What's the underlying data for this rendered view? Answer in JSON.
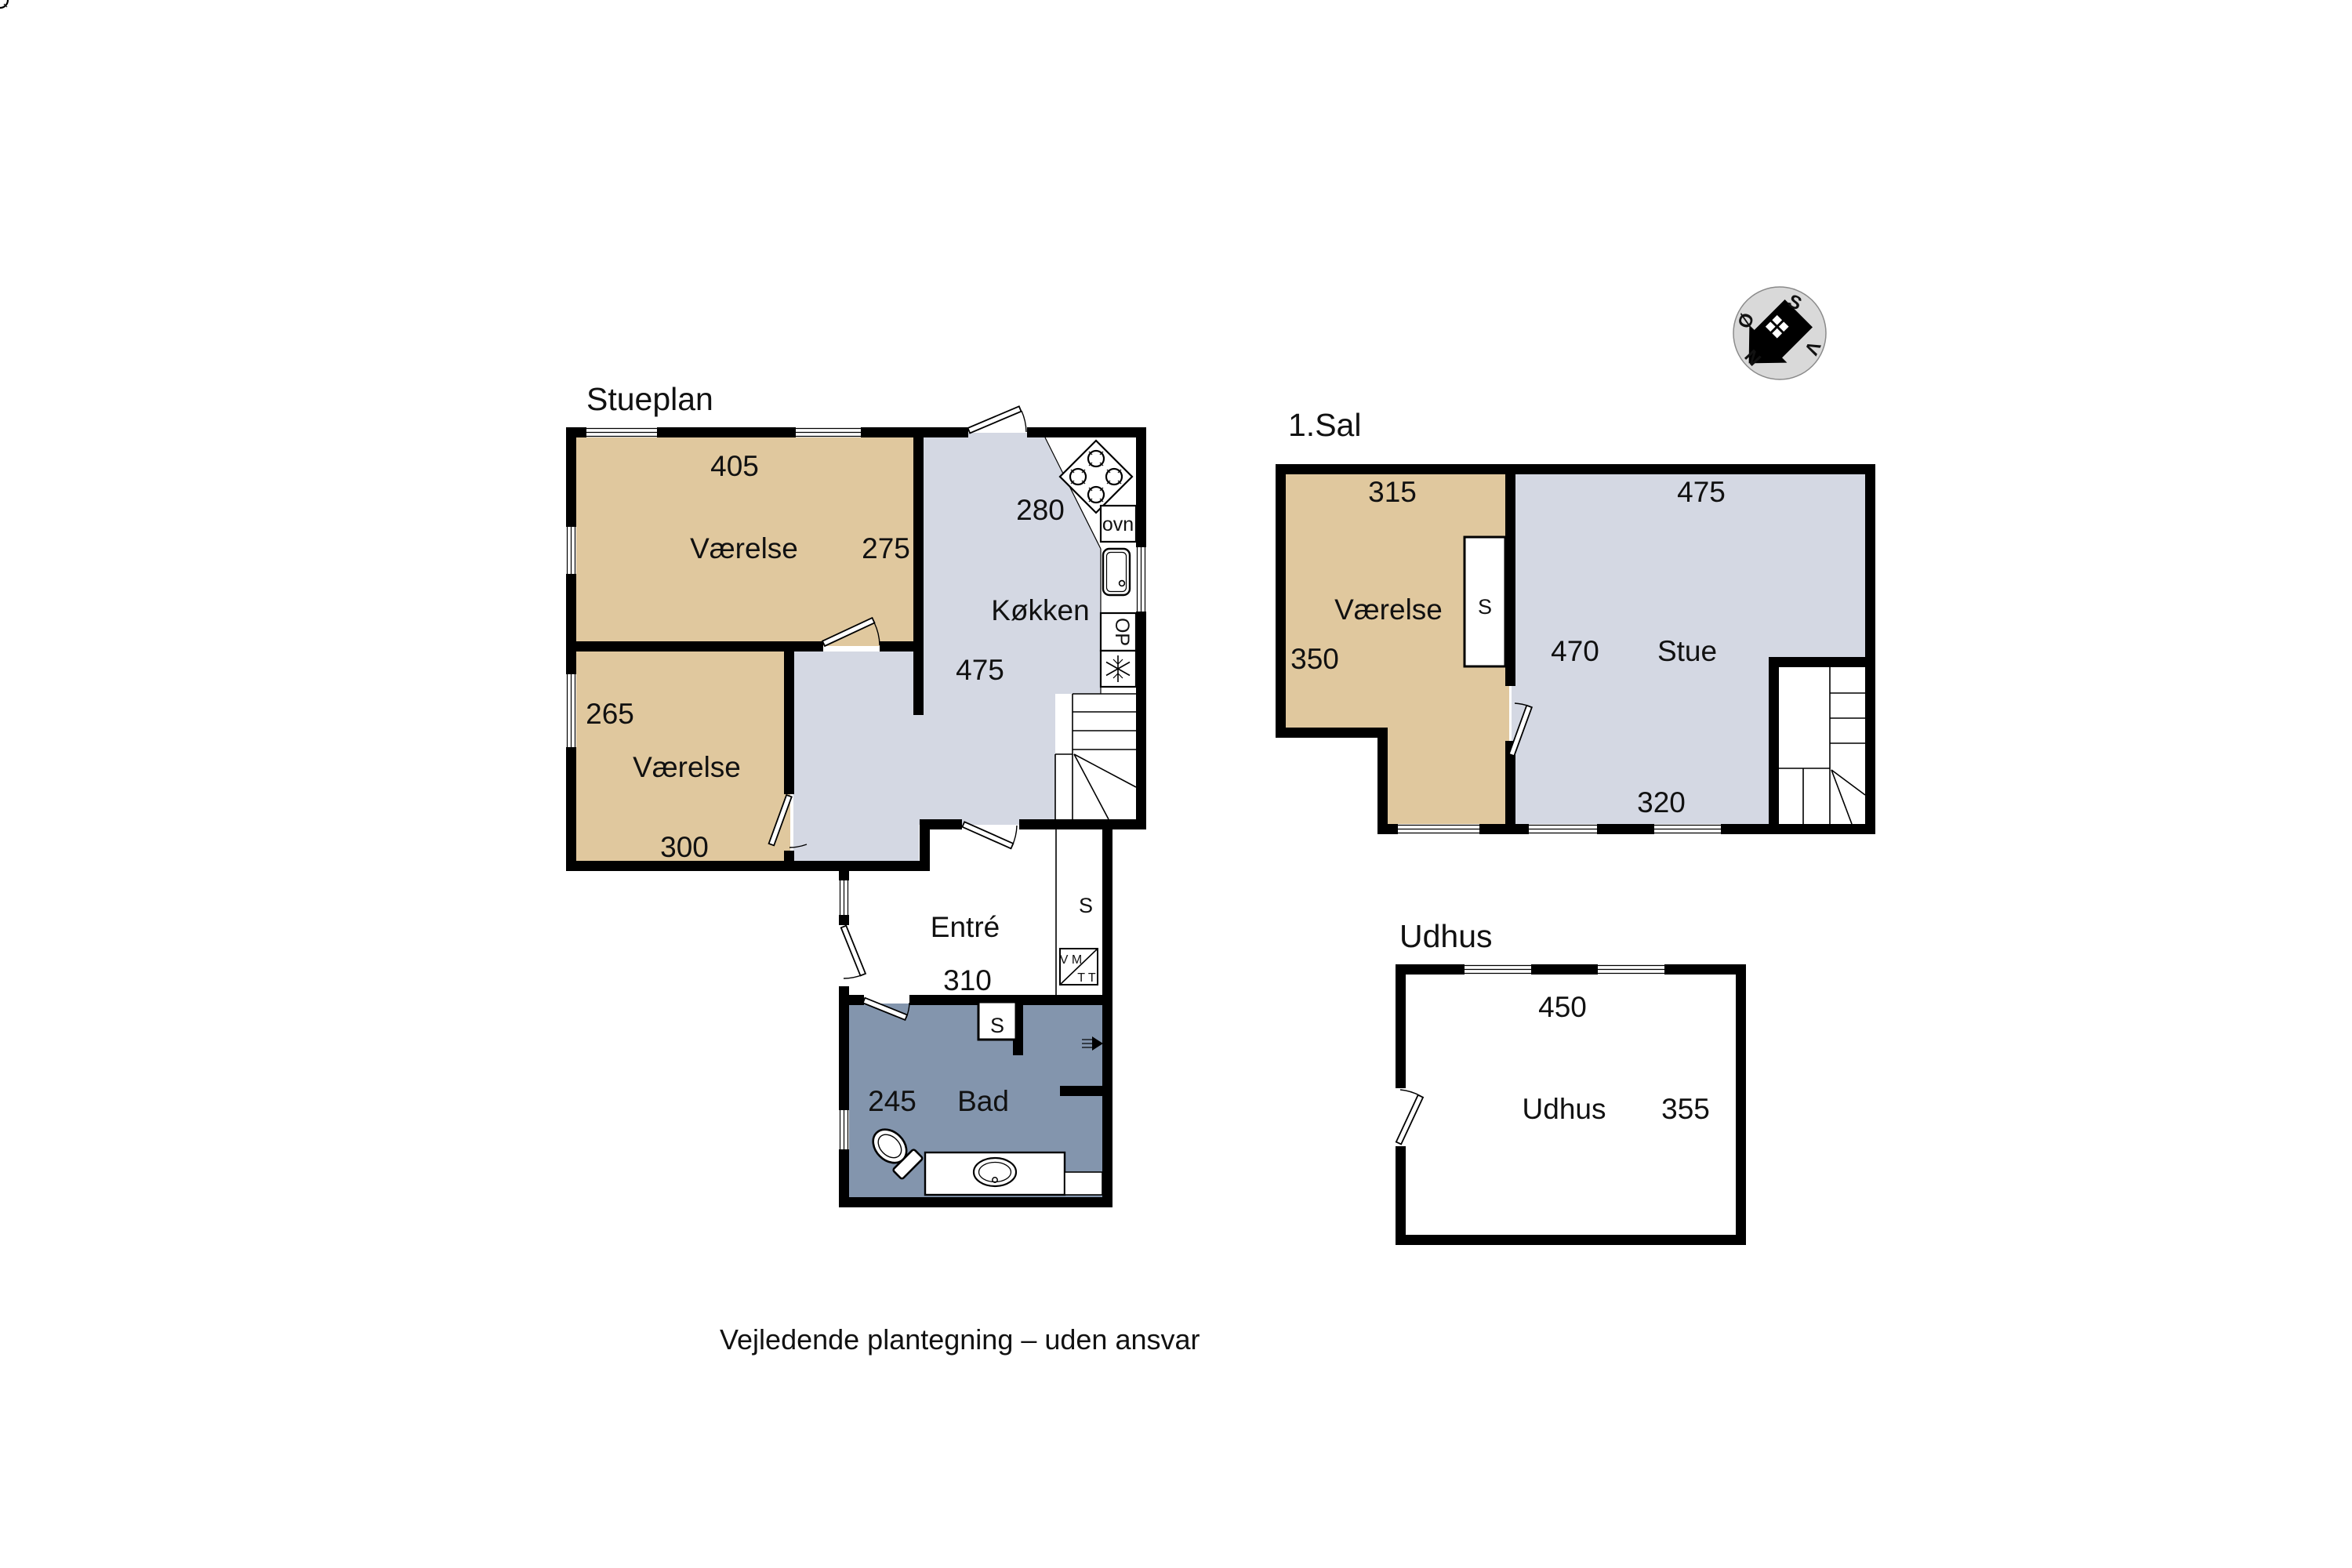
{
  "footer": "Vejledende plantegning – uden ansvar",
  "colors": {
    "room_tan": "#e0c89e",
    "room_gray": "#d4d8e3",
    "room_blue": "#8395ad",
    "compass_fill": "#d9d9d9"
  },
  "compass": {
    "north": "N",
    "south": "S",
    "east": "Ø",
    "west": "V"
  },
  "stueplan": {
    "title": "Stueplan",
    "bedroom1": {
      "name": "Værelse",
      "width": "405",
      "depth": "275"
    },
    "bedroom2": {
      "name": "Værelse",
      "depth": "265",
      "width": "300"
    },
    "kitchen": {
      "name": "Køkken",
      "width": "475",
      "depth": "280",
      "oven": "ovn",
      "dishwasher": "OP"
    },
    "entre": {
      "name": "Entré",
      "width": "310",
      "closet": "S",
      "washer": "V M",
      "dryer": "T T"
    },
    "bath": {
      "name": "Bad",
      "width": "245",
      "closet": "S"
    }
  },
  "first_floor": {
    "title": "1.Sal",
    "bedroom": {
      "name": "Værelse",
      "width": "315",
      "depth": "350",
      "closet": "S"
    },
    "living": {
      "name": "Stue",
      "width": "475",
      "depth": "470",
      "width2": "320"
    }
  },
  "outbuilding": {
    "title": "Udhus",
    "room": {
      "name": "Udhus",
      "width": "450",
      "depth": "355"
    }
  }
}
